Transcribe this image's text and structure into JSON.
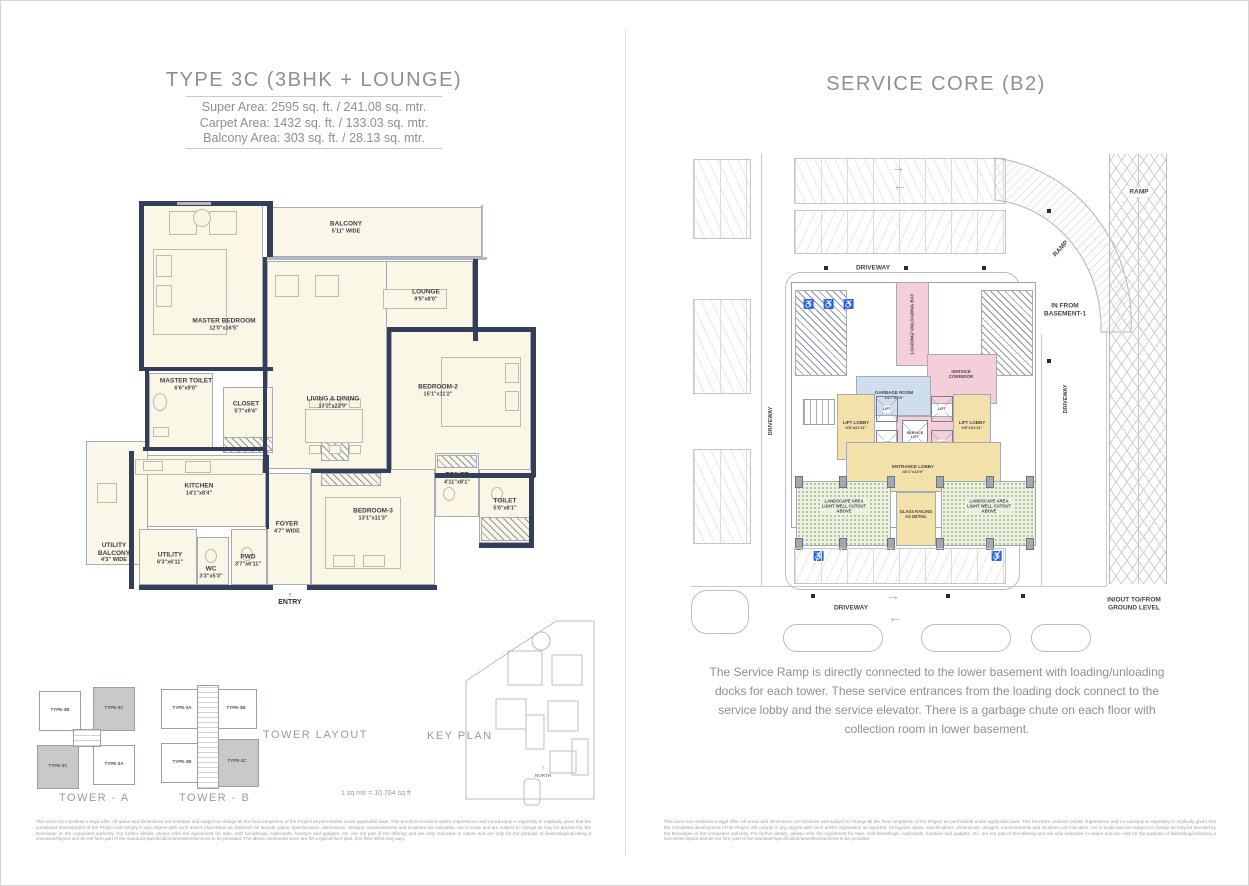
{
  "left": {
    "title": "TYPE 3C (3BHK + LOUNGE)",
    "areas": {
      "super": "Super Area: 2595 sq. ft. / 241.08 sq. mtr.",
      "carpet": "Carpet Area: 1432 sq. ft. / 133.03 sq. mtr.",
      "balcony": "Balcony Area: 303 sq. ft. / 28.13 sq. mtr."
    },
    "rooms": {
      "master_bedroom": {
        "label": "MASTER BEDROOM",
        "dim": "12'0\"x16'5\""
      },
      "balcony": {
        "label": "BALCONY",
        "dim": "5'11\" WIDE"
      },
      "lounge": {
        "label": "LOUNGE",
        "dim": "9'5\"x8'0\""
      },
      "living_dining": {
        "label": "LIVING & DINING",
        "dim": "13'2\"x23'9\""
      },
      "bedroom2": {
        "label": "BEDROOM-2",
        "dim": "15'1\"x11'2\""
      },
      "master_toilet": {
        "label": "MASTER TOILET",
        "dim": "6'6\"x9'0\""
      },
      "closet": {
        "label": "CLOSET",
        "dim": "5'7\"x9'4\""
      },
      "kitchen": {
        "label": "KITCHEN",
        "dim": "14'1\"x8'4\""
      },
      "utility_balcony": {
        "label": "UTILITY BALCONY",
        "dim": "4'3\" WIDE"
      },
      "utility": {
        "label": "UTILITY",
        "dim": "6'3\"x6'11\""
      },
      "wc": {
        "label": "WC",
        "dim": "3'3\"x5'3\""
      },
      "pwd": {
        "label": "PWD",
        "dim": "3'7\"x6'11\""
      },
      "foyer": {
        "label": "FOYER",
        "dim": "4'7\" WIDE"
      },
      "bedroom3": {
        "label": "BEDROOM-3",
        "dim": "13'1\"x11'3\""
      },
      "toilet1": {
        "label": "TOILET",
        "dim": "4'11\"x8'1\""
      },
      "toilet2": {
        "label": "TOILET",
        "dim": "5'0\"x8'1\""
      },
      "entry": "ENTRY",
      "entry_arrow": "↑"
    },
    "footer": {
      "tower_layout": "TOWER LAYOUT",
      "key_plan": "KEY PLAN",
      "tower_a": "TOWER - A",
      "tower_b": "TOWER - B",
      "scale_note": "1 sq mtr = 10.764 sq ft",
      "north": "NORTH",
      "north_arrow": "↑",
      "tower_a_units": {
        "tl": "TYPE-3B",
        "tr": "TYPE-3C",
        "bl": "TYPE-3C",
        "br": "TYPE-3A"
      },
      "tower_b_units": {
        "tl": "TYPE-3A",
        "tr": "TYPE-3B",
        "bl": "TYPE-3B",
        "br": "TYPE-3C"
      }
    },
    "disclaimer": "This does not constitute a legal offer. All areas and dimensions are tentative and subject to change till the final completion of the Project as permissible under applicable laws. This brochure contains artistic impressions and no warranty is expressly or impliedly given that the completed development of the Project will comply in any degree with such artist's impression as depicted. All layouts, plans, specifications, dimensions, designs, measurements and locations are indicative, not to scale and are subject to change as may be decided by the Developer or the competent authority. For further details, please refer the Agreement for Sale. Soft furnishings, cupboards, furniture and gadgets, etc. are not part of the offering and are only indicative in nature and are only for the purpose of illustrating/indicating a conceived layout and do not form part of the standard specification/amenities/services to be provided. The above mentioned sizes are for a typical floor plan, first floor sizes may vary."
  },
  "right": {
    "title": "SERVICE CORE (B2)",
    "plan": {
      "driveway": "DRIVEWAY",
      "ramp": "RAMP",
      "in_from_basement": "IN FROM BASEMENT-1",
      "loading_bay": "LOADING/ UNLOADING BAY",
      "service_corridor": "SERVICE CORRIDOR",
      "garbage_room": {
        "label": "GARBAGE ROOM",
        "dim": "24'7\"x8'5\""
      },
      "lift_lobby": {
        "label": "LIFT LOBBY",
        "dim": "9'8\"x21'11\""
      },
      "lift": "LIFT",
      "service_lift": "SERVICE LIFT",
      "entrance_lobby": {
        "label": "ENTRANCE LOBBY",
        "dim": "46'1\"x11'9\""
      },
      "glass_railing": "GLASS RAILING AS DETAIL",
      "landscape_area": "LANDSCAPE AREA LIGHT WELL CUTOUT ABOVE",
      "in_out": "IN/OUT TO/FROM GROUND LEVEL",
      "arrow_right": "→",
      "arrow_left": "←",
      "handicap": "♿"
    },
    "description": "The Service Ramp is directly connected to the lower basement with loading/unloading docks for each tower. These service entrances from the loading dock connect to the service lobby and the service elevator. There is a garbage chute on each floor with collection room in lower basement.",
    "disclaimer": "This does not constitute a legal offer. All areas and dimensions are tentative and subject to change till the final completion of the Project as permissible under applicable laws. This brochure contains artistic impressions and no warranty is expressly or impliedly given that the completed development of the Project will comply in any degree with such artist's impression as depicted. All layouts, plans, specifications, dimensions, designs, measurements and locations are indicative, not to scale and are subject to change as may be decided by the Developer or the competent authority. For further details, please refer the Agreement for Sale. Soft furnishings, cupboards, furniture and gadgets, etc. are not part of the offering and are only indicative in nature and are only for the purpose of illustrating/indicating a conceived layout and do not form part of the standard specification/amenities/services to be provided."
  },
  "colors": {
    "wall_navy": "#333e5a",
    "room_cream": "#faf7e6",
    "accent_pink": "#f4cfd9",
    "accent_yellow": "#f2e2aa",
    "accent_blue": "#cfdeec",
    "landscape_green": "#9bb989",
    "text_gray": "#8f8f8f"
  }
}
